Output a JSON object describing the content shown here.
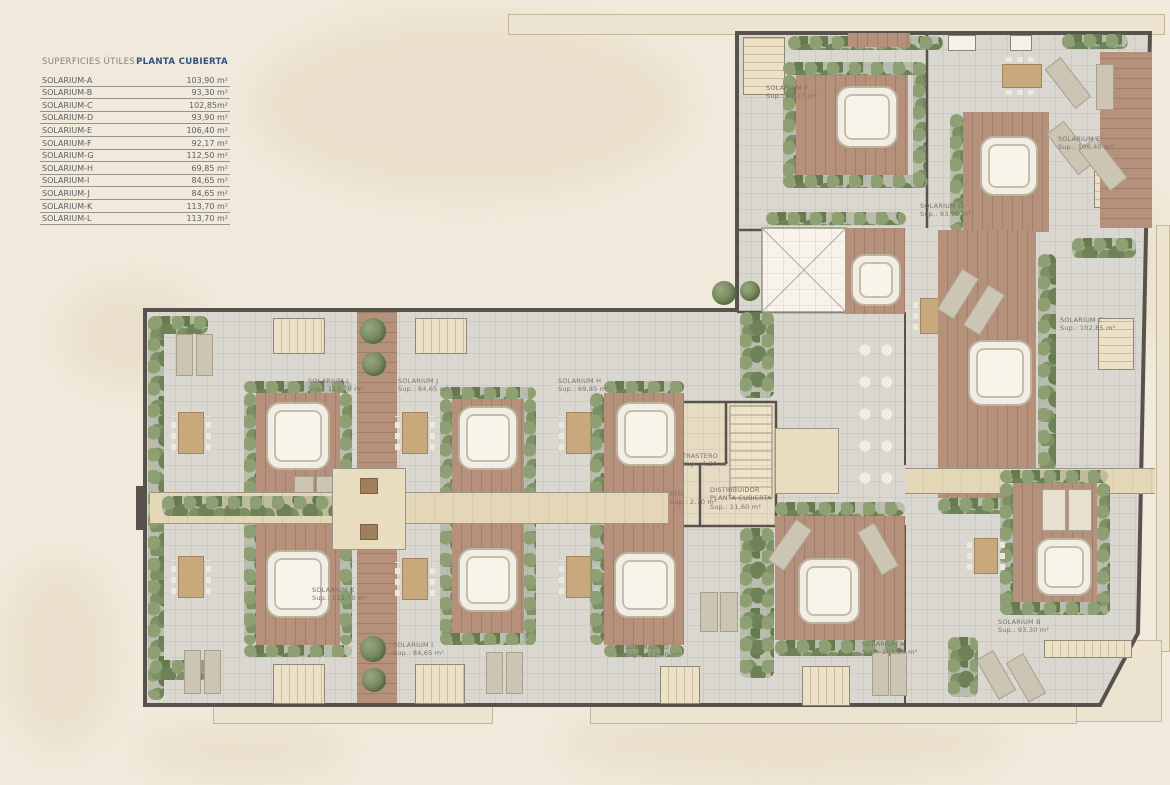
{
  "page_title": "PLANTA CUBIERTA",
  "legend": {
    "title_left": "SUPERFICIES ÚTILES",
    "title_right": "PLANTA CUBIERTA",
    "rows": [
      {
        "name": "SOLARIUM-A",
        "value": "103,90 m²"
      },
      {
        "name": "SOLARIUM-B",
        "value": "93,30 m²"
      },
      {
        "name": "SOLARIUM-C",
        "value": "102,85m²"
      },
      {
        "name": "SOLARIUM-D",
        "value": "93,90 m²"
      },
      {
        "name": "SOLARIUM-E",
        "value": "106,40 m²"
      },
      {
        "name": "SOLARIUM-F",
        "value": "92,17 m²"
      },
      {
        "name": "SOLARIUM-G",
        "value": "112,50 m²"
      },
      {
        "name": "SOLARIUM-H",
        "value": "69,85 m²"
      },
      {
        "name": "SOLARIUM-I",
        "value": "84,65 m²"
      },
      {
        "name": "SOLARIUM-J",
        "value": "84,65 m²"
      },
      {
        "name": "SOLARIUM-K",
        "value": "113,70 m²"
      },
      {
        "name": "SOLARIUM-L",
        "value": "113,70 m²"
      }
    ]
  },
  "plan": {
    "labels": {
      "a": {
        "name": "SOLARIUM A",
        "sup": "Sup.: 103,90 m²"
      },
      "b": {
        "name": "SOLARIUM B",
        "sup": "Sup.: 93,30 m²"
      },
      "c": {
        "name": "SOLARIUM C",
        "sup": "Sup.: 102,85 m²"
      },
      "d": {
        "name": "SOLARIUM D",
        "sup": "Sup.: 93,90 m²"
      },
      "e": {
        "name": "SOLARIUM E",
        "sup": "Sup.: 106,40 m²"
      },
      "f": {
        "name": "SOLARIUM F",
        "sup": "Sup.: 92,17 m²"
      },
      "g": {
        "name": "SOLARIUM G",
        "sup": "Sup.: 112,50 m²"
      },
      "h": {
        "name": "SOLARIUM H",
        "sup": "Sup.: 69,85 m²"
      },
      "i": {
        "name": "SOLARIUM I",
        "sup": "Sup.: 84,65 m²"
      },
      "j": {
        "name": "SOLARIUM J",
        "sup": "Sup.: 84,65 m²"
      },
      "k": {
        "name": "SOLARIUM K",
        "sup": "Sup.: 113,70 m²"
      },
      "l": {
        "name": "SOLARIUM L",
        "sup": "Sup.: 113,70 m²"
      },
      "trastero": {
        "name": "TRASTERO",
        "sup": "Sup.: 4,30 m²"
      },
      "riti": {
        "name": "RITI",
        "sup": "Sup.: 2,70 m²"
      },
      "distribuidor": {
        "line1": "DISTRIBUIDOR",
        "line2": "PLANTA CUBIERTA",
        "sup": "Sup.: 11,60 m²"
      }
    },
    "colors": {
      "accent_blue": "#31517E",
      "wall": "#57534C",
      "deck_wood": "#B5917B",
      "hedge_green": "#76895C",
      "tile": "#DAD7D1",
      "background": "#F1EADC"
    }
  }
}
